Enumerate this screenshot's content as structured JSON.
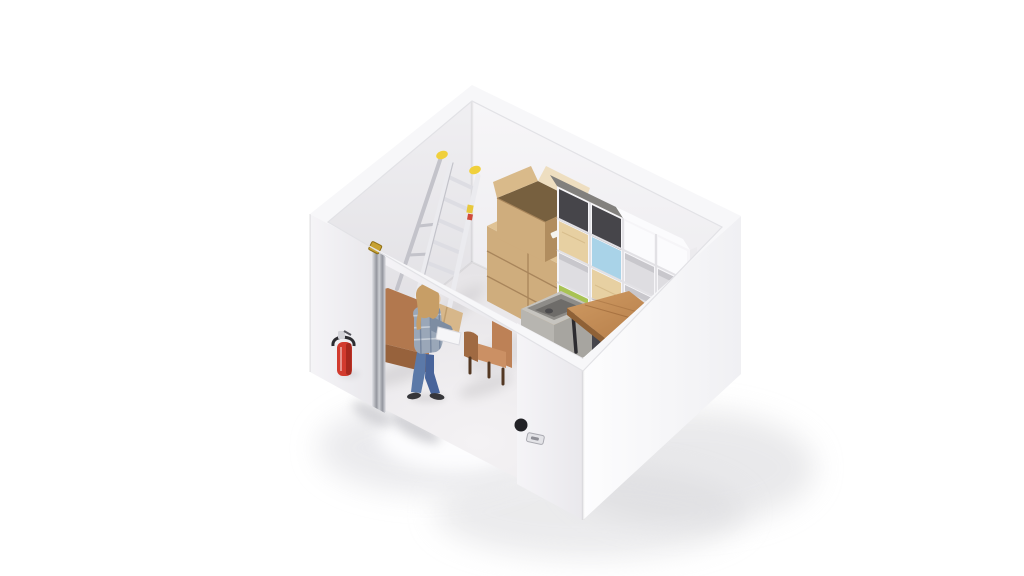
{
  "meta": {
    "title": "Isometric 3D render of a self-storage unit with furniture and boxes",
    "background": "#ffffff"
  },
  "colors": {
    "bg": "#ffffff",
    "rimTop": "#f7f7f9",
    "rimEdge": "#e2e2e6",
    "wallBackLeftA": "#f0eff2",
    "wallBackLeftB": "#dddce0",
    "wallBackRightA": "#f7f6f8",
    "wallBackRightB": "#e9e8ec",
    "wallFrontLeftA": "#f5f4f7",
    "wallFrontLeftB": "#e9e8ec",
    "wallFrontRightA": "#fdfdfe",
    "wallFrontRightB": "#f0f0f3",
    "floorA": "#f4f2f4",
    "floorB": "#e2e0e3",
    "shadowSoft": "#d8d8db",
    "shadowOuter": "#e7e7ea",
    "spill": "#fdfdfe",
    "castShadow": "#c7c7cc",
    "ladderRail": "#ebebef",
    "ladderRailShade": "#c3c3ca",
    "ladderRung": "#dddde3",
    "ladderCap": "#f0d03c",
    "stickerYellow": "#e8c83c",
    "stickerRed": "#d04a3a",
    "boxTop": "#e0c395",
    "boxLeft": "#cfad7d",
    "boxRight": "#b18d5f",
    "boxSeam": "#a8855b",
    "boxFlapOuter": "#d9ba8a",
    "boxFlapInner": "#eedec0",
    "boxInterior": "#77603f",
    "boxLabel": "#f5f4ef",
    "boxTape": "#caa876",
    "shelfWhite": "#f6f5f8",
    "shelfWhiteShade": "#e2e1e5",
    "shelfOpenInner": "#dedde1",
    "shelfOpenDark": "#c8c7cc",
    "shelfDark": "#46454a",
    "shelfDarkTop": "#82807d",
    "shelfBlue": "#a9d3e8",
    "shelfGreen": "#a8c354",
    "shelfPine": "#e7d0a2",
    "shelfPineShade": "#d4b987",
    "shelfSide": "#ecebee",
    "shelfPanelWhite": "#fbfbfd",
    "tableTopA": "#d09b63",
    "tableTopB": "#b27a46",
    "tableEdge": "#8f6136",
    "tableLeg": "#2d2c30",
    "cabinetA": "#47474e",
    "cabinetB": "#2a2a2f",
    "cabinetTop": "#55555c",
    "troughRim": "#c6c4bf",
    "troughFaceL": "#b7b5b0",
    "troughFaceR": "#a7a5a0",
    "troughInner": "#8e8c88",
    "troughDark": "#6e6c69",
    "wingMain": "#b2784e",
    "wingShade": "#97623c",
    "wingFoot": "#4a3526",
    "cushionTan": "#d7b78a",
    "cushionShade": "#c09e6e",
    "armMain": "#bd8156",
    "armLight": "#cb9064",
    "armShade": "#a06a42",
    "armLeg": "#533823",
    "hair": "#c79e66",
    "skin": "#e9c8a0",
    "shirtA": "#9aa7b8",
    "shirtB": "#7e8da2",
    "jeans": "#5b79a8",
    "jeansShade": "#48649a",
    "shoes": "#36363a",
    "heldItem": "#f6f6f8",
    "extRed": "#d23b2e",
    "extRedDark": "#a8291e",
    "extMetal": "#d3d3d8",
    "extBracket": "#2c2c30",
    "chromeA": "#e2e3e7",
    "chromeB": "#93959d",
    "chromeC": "#ccced3",
    "brass": "#c7a233",
    "brassDark": "#8f6f16",
    "latchFace": "#e3e3e7",
    "latchEdge": "#aaaab1",
    "latchSlot": "#8f8f96",
    "lockDark": "#222226"
  },
  "objects": {
    "unit": {
      "label": "Self-storage unit, isometric cutaway view with open top"
    },
    "ladder": {
      "label": "Aluminum A-frame step ladder with yellow top caps"
    },
    "boxes": {
      "label": "Stack of kraft cardboard moving boxes"
    },
    "openBox": {
      "label": "Open cardboard box with raised flaps and handle holes"
    },
    "shelf": {
      "label": "Cube shelving unit with dark gray, blue, green, pine and white panels"
    },
    "table": {
      "label": "Wooden table with black metal legs"
    },
    "cabinet": {
      "label": "Dark cabinet under table"
    },
    "trough": {
      "label": "Concrete storage trough"
    },
    "wingChair": {
      "label": "Tall brown wingback armchair behind the door"
    },
    "cushion": {
      "label": "Tan cushion leaning against armchair"
    },
    "armchair": {
      "label": "Small brown armchair"
    },
    "person": {
      "label": "Woman in plaid shirt and jeans standing in the doorway holding a white box"
    },
    "extinguisher": {
      "label": "Red fire extinguisher mounted on exterior wall"
    },
    "door": {
      "label": "Open door seen edge-on with chrome edge and brass hinge"
    },
    "latch": {
      "label": "Door latch plate on front wall"
    },
    "lock": {
      "label": "Round dark lock fitting"
    }
  }
}
